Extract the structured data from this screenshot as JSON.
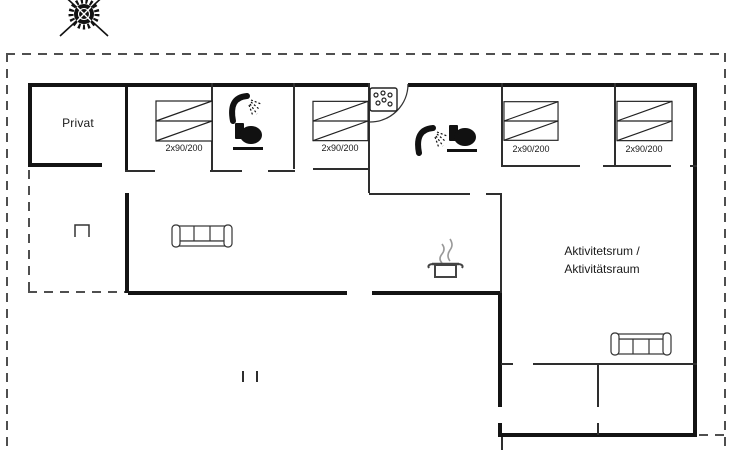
{
  "rooms": {
    "privat": {
      "label": "Privat"
    },
    "activity_room": {
      "label_line1": "Aktivitetsrum /",
      "label_line2": "Aktivitätsraum"
    }
  },
  "beds": [
    {
      "label": "2x90/200"
    },
    {
      "label": "2x90/200"
    },
    {
      "label": "2x90/200"
    },
    {
      "label": "2x90/200"
    }
  ],
  "icons": {
    "compass": "compass-rose",
    "bathroom_1": [
      "shower",
      "toilet"
    ],
    "bathroom_2": [
      "shower",
      "toilet"
    ],
    "utility": "washing-machine",
    "kitchen": "cooking-pot-with-steam",
    "living_room": "sofa",
    "activity_room": "sofa",
    "terrace": "open-rectangle-marker",
    "entrance": "door-swing-arc"
  },
  "colors": {
    "wall": "#141414",
    "line": "#2e2e2e",
    "boundary": "#4f4f4f",
    "background": "#ffffff"
  }
}
